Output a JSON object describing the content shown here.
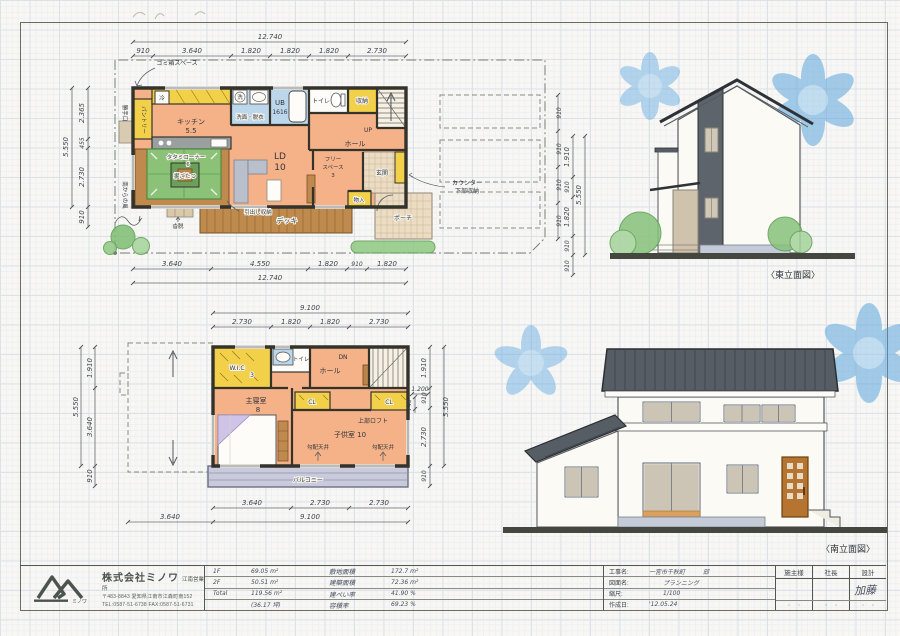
{
  "plan_1f": {
    "dims": {
      "top_total": "12.740",
      "top": [
        "910",
        "3.640",
        "1.820",
        "1.820",
        "1.820",
        "2.730"
      ],
      "bottom": [
        "3.640",
        "4.550",
        "1.820",
        "910",
        "1.820"
      ],
      "bottom_total": "12.740",
      "left": [
        "2.365",
        "455",
        "2.730"
      ],
      "left_total": "5.550",
      "left_below": "910",
      "site": [
        "910",
        "910",
        "910",
        "910"
      ]
    },
    "labels": {
      "trash": "ゴミ箱スペース",
      "fridge": "冷",
      "kitchen": "キッチン",
      "kitchen_size": "5.5",
      "pantry": "パントリー",
      "backdoor": "勝手口",
      "washer": "洗",
      "washroom": "洗面・脱衣",
      "bath": "UB",
      "bath_size": "1616",
      "toilet": "トイレ",
      "storage": "収納",
      "up": "UP",
      "hall": "ホール",
      "ld": "LD",
      "ld_size": "10",
      "tatami": "タタミコーナー",
      "tatami_size": "6",
      "kotatsu": "掘ごたつ",
      "free_1": "フリー",
      "free_2": "スペース",
      "free_size": "3",
      "genkan": "玄関",
      "closet": "物入",
      "counter_1": "カウンター",
      "counter_2": "下部収納",
      "porch": "ポーチ",
      "deck": "デッキ",
      "drawer": "引出し収納",
      "step": "沓脱",
      "south_wind": "南からの風"
    }
  },
  "plan_2f": {
    "dims": {
      "top_total": "9.100",
      "top": [
        "2.730",
        "1.820",
        "1.820",
        "2.730"
      ],
      "bottom": [
        "3.640",
        "2.730",
        "2.730"
      ],
      "bottom_total": "9.100",
      "bottom_left": "3.640",
      "left": [
        "1.910",
        "3.640",
        "910"
      ],
      "left_total": "5.550",
      "right": [
        "1.910",
        "910",
        "2.730",
        "910"
      ],
      "right_total": "5.550",
      "inner_w": "1.200",
      "inner_h": "740"
    },
    "labels": {
      "wic": "W.I.C",
      "wic_size": "3",
      "toilet": "トイレ",
      "hall": "ホール",
      "dn": "DN",
      "master": "主寝室",
      "master_size": "8",
      "cl_left": "CL",
      "cl_right": "CL",
      "kids": "子供室 10",
      "loft": "上部ロフト",
      "slope_left": "勾配天井",
      "slope_right": "勾配天井",
      "balcony": "バルコニー"
    }
  },
  "elev_east": {
    "caption": "〈東立面図〉",
    "dims": {
      "segs": [
        "1.910",
        "910",
        "1.820",
        "910"
      ],
      "total": "5.550",
      "below": "910"
    }
  },
  "elev_south": {
    "caption": "〈南立面図〉"
  },
  "title_block": {
    "company": {
      "name": "株式会社ミノワ",
      "branch": "江南営業所",
      "address": "〒483-8843 愛知県江南市江森町南152",
      "tel": "TEL:0587-51-6738 FAX:0587-51-6731",
      "logo_caption": "ミノワ"
    },
    "areas": {
      "rows": [
        [
          "1F",
          "69.05 m²"
        ],
        [
          "2F",
          "50.51 m²"
        ],
        [
          "Total",
          "119.56 m²"
        ],
        [
          "",
          "(36.17 坪)"
        ]
      ]
    },
    "metrics": {
      "rows": [
        [
          "敷地面積",
          "172.7 m²"
        ],
        [
          "建築面積",
          "72.36 m²"
        ],
        [
          "建ペい率",
          "41.90 %"
        ],
        [
          "容積率",
          "69.23 %"
        ]
      ]
    },
    "project": {
      "rows": [
        [
          "工事名:",
          "一宮市千秋町　　　邸"
        ],
        [
          "図面名:",
          "プランニング"
        ],
        [
          "縮尺:",
          "1/100"
        ],
        [
          "作成日:",
          "'12.05.24"
        ]
      ]
    },
    "approvals": {
      "headers": [
        "施主様",
        "社長",
        "設計"
      ],
      "stamp": "加藤",
      "dots": "・　・"
    }
  }
}
